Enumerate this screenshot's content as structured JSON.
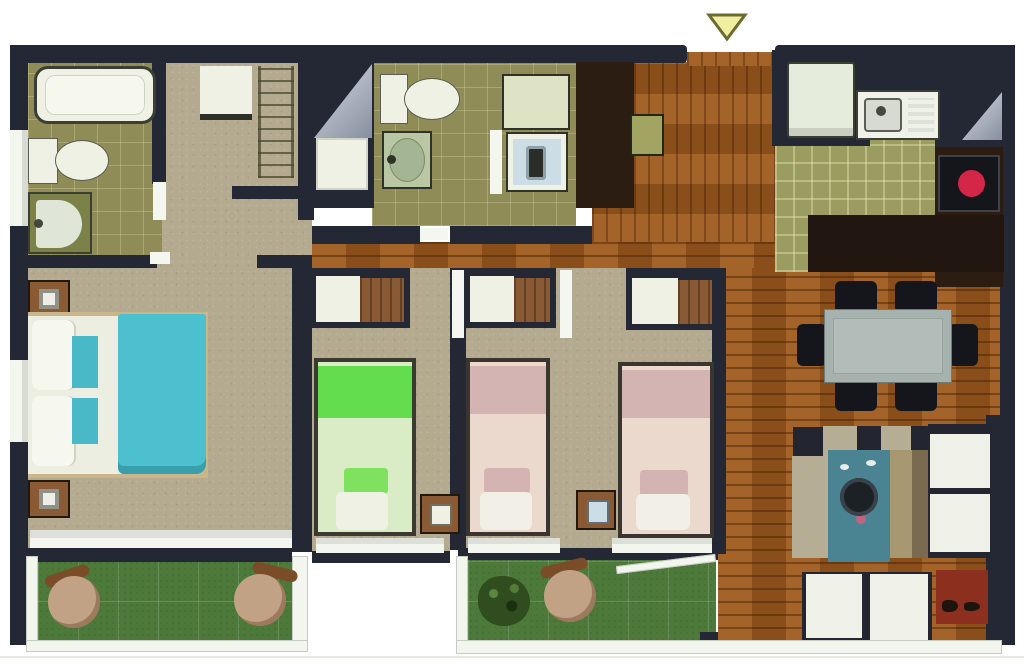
{
  "type": "apartment-floor-plan",
  "palette": {
    "wall": "#242834",
    "wall_brown": "#2b1d12",
    "counter_dark": "#221610",
    "cooktop_black": "#15161c",
    "bath_tile": "#8f8c57",
    "vanity_olive": "#7c8148",
    "vanity_green": "#b9c7a4",
    "carpet": "#b3aa8f",
    "wood": "#9a5a20",
    "kitchen_tile": "#9b9c60",
    "grass": "#4d7a3a",
    "white_fixture": "#eef1e4",
    "pale_green_counter": "#dde3c4",
    "washer_panel": "#ccdde6",
    "teal_bed": "#4cc0cf",
    "teal_pillow": "#49b9c8",
    "green_blanket": "#63dc4d",
    "green_pillow": "#7ee25f",
    "green_sheet": "#d9ecc6",
    "pink_blanket": "#d3b4b2",
    "pink_sheet": "#ead9cc",
    "bedframe_tan": "#c9b68b",
    "nightstand_brown": "#8a5a35",
    "cabinet_green": "#a2a462",
    "table_grey": "#a6b2ae",
    "chair_dark": "#14161c",
    "burner_red": "#d42646",
    "rug_teal": "#4a8492",
    "rug_dot_pink": "#c06580",
    "tan_chair": "#c2a284",
    "chair_back_brown": "#7b4c28",
    "bush_green": "#2f4d1e",
    "mat_red": "#8c2f1f",
    "rail_white": "#f3f5ef",
    "arrow_yellow": "#f0efa0",
    "arrow_border": "#6b6b2f",
    "sofa_side_beige": "#b5ad94",
    "sofa_side_dark": "#232630",
    "door_leaf": "#f4f6f0"
  },
  "entry": {
    "marker": "down-arrow"
  },
  "rooms": [
    {
      "id": "bathroom-1",
      "floor": "olive-tile",
      "furniture": [
        "bathtub",
        "toilet",
        "sink-vanity"
      ]
    },
    {
      "id": "hallway",
      "floor": "carpet",
      "furniture": [
        "closet",
        "shelving-rack"
      ]
    },
    {
      "id": "bathroom-2",
      "floor": "olive-tile",
      "furniture": [
        "shower-tray",
        "toilet",
        "sink-vanity",
        "counter",
        "washing-machine"
      ],
      "symbols": [
        "door-swing-triangle"
      ]
    },
    {
      "id": "entry-hall",
      "floor": "wood",
      "furniture": [
        "cabinet"
      ],
      "symbols": [
        "entry-arrow"
      ]
    },
    {
      "id": "kitchen",
      "floor": "green-plaid-tile",
      "furniture": [
        "refrigerator",
        "sink-counter",
        "cooktop",
        "bar-counter",
        "cabinet-column"
      ],
      "symbols": [
        "door-swing-triangle"
      ]
    },
    {
      "id": "dining-area",
      "floor": "wood",
      "furniture": [
        "dining-table",
        "dining-chair",
        "dining-chair",
        "dining-chair",
        "dining-chair",
        "dining-chair",
        "dining-chair"
      ]
    },
    {
      "id": "living-area",
      "floor": "wood",
      "furniture": [
        "corner-sofa",
        "armchair-cushions",
        "teal-rug",
        "round-coffee-table",
        "red-doormat"
      ]
    },
    {
      "id": "master-bedroom",
      "floor": "carpet",
      "furniture": [
        "double-bed-teal",
        "nightstand",
        "nightstand",
        "window"
      ]
    },
    {
      "id": "bedroom-2",
      "floor": "carpet",
      "furniture": [
        "single-bed-green",
        "wardrobe",
        "nightstand",
        "window"
      ]
    },
    {
      "id": "bedroom-3",
      "floor": "carpet",
      "furniture": [
        "single-bed-pink",
        "single-bed-pink",
        "wardrobe",
        "wardrobe",
        "nightstand",
        "window",
        "window"
      ]
    },
    {
      "id": "terrace-1",
      "floor": "grass",
      "furniture": [
        "round-lounge-chair",
        "round-lounge-chair"
      ]
    },
    {
      "id": "terrace-2",
      "floor": "grass",
      "furniture": [
        "shrub",
        "round-lounge-chair"
      ]
    }
  ]
}
